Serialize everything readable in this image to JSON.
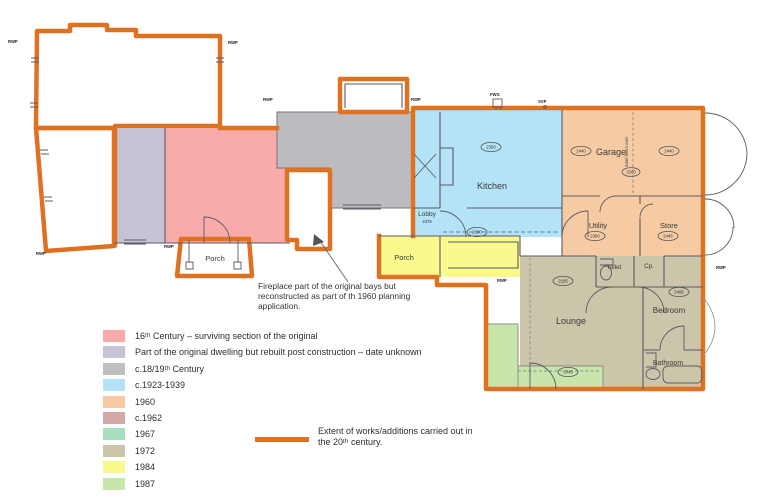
{
  "colors": {
    "outline": "#DE7220",
    "c16": "#F9AAAA",
    "rebuilt": "#C8C2D7",
    "c1819": "#BCBCC0",
    "c1923": "#B4E3F7",
    "y1960": "#F6CBA3",
    "c1962": "#D3A9A5",
    "y1967": "#A9DFC1",
    "y1972": "#CBC5AA",
    "y1984": "#FAF98D",
    "y1987": "#C8E5AC"
  },
  "rooms": {
    "kitchen": "Kitchen",
    "lobby": "Lobby",
    "porch_left": "Porch",
    "porch_front": "Porch",
    "garage": "Garage",
    "utility": "Utility",
    "store": "Store",
    "toilet": "Toilet",
    "cupboard": "Cp.",
    "lounge": "Lounge",
    "bedroom": "Bedroom",
    "bathroom": "Bathroom"
  },
  "dims": {
    "kitchen": "2360",
    "garage_left": "2440",
    "garage_right": "2440",
    "garage_beam": "3200",
    "utility": "2360",
    "store": "2445",
    "lounge": "2185",
    "bedroom": "2495",
    "porch_front": "2190",
    "conservatory": "2045",
    "lobby": "2375"
  },
  "pipes": {
    "rwp": "RWP",
    "svp": "SVP",
    "fwg": "FWG"
  },
  "notes": {
    "steel_beam": "Steel beam over",
    "fireplace": "Fireplace part of the original bays but reconstructed as part of th 1960 planning application."
  },
  "legend": {
    "items": [
      {
        "label": "16ᵗʰ Century – surviving section of the original",
        "color": "#F9AAAA"
      },
      {
        "label": "Part of the original dwelling but rebuilt post construction – date unknown",
        "color": "#C8C2D7"
      },
      {
        "label": "c.18/19ᵗʰ Century",
        "color": "#BFBFBF"
      },
      {
        "label": "c.1923-1939",
        "color": "#B4E3F7"
      },
      {
        "label": "1960",
        "color": "#F6CBA3"
      },
      {
        "label": "c.1962",
        "color": "#D3A9A5"
      },
      {
        "label": "1967",
        "color": "#A9DFC1"
      },
      {
        "label": "1972",
        "color": "#CBC5AA"
      },
      {
        "label": "1984",
        "color": "#FAF98D"
      },
      {
        "label": "1987",
        "color": "#C8E5AC"
      }
    ],
    "extent": {
      "label": "Extent of works/additions carried out in the 20ᵗʰ century.",
      "color": "#DE7220"
    }
  }
}
